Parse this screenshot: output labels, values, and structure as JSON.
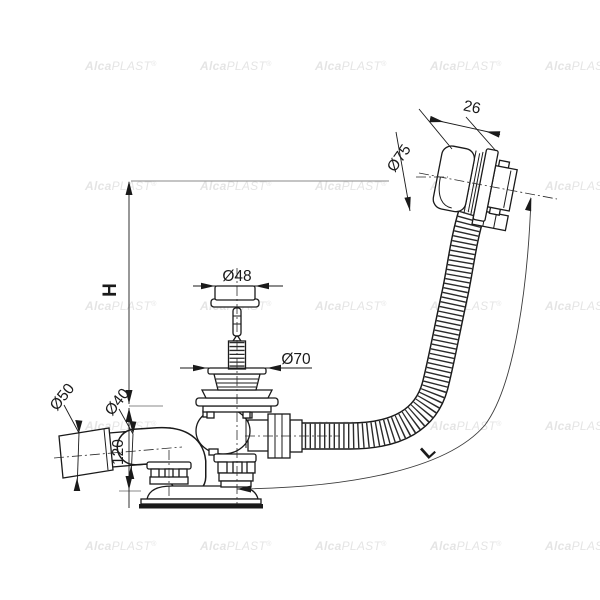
{
  "labels": {
    "height": "H",
    "hose_length": "L",
    "cap_depth": "26",
    "cap_diameter": "Ø75",
    "plug_diameter": "Ø48",
    "strainer_diameter": "Ø70",
    "outlet_outer_diameter": "Ø50",
    "outlet_inner_diameter": "Ø40",
    "base_height": "120"
  },
  "watermark": {
    "bold": "Alca",
    "light": "PLAST",
    "reg": "®"
  },
  "colors": {
    "background": "#ffffff",
    "line": "#1a1a1a",
    "reference_line": "#8a8a8a",
    "watermark": "#a9a9a9"
  }
}
